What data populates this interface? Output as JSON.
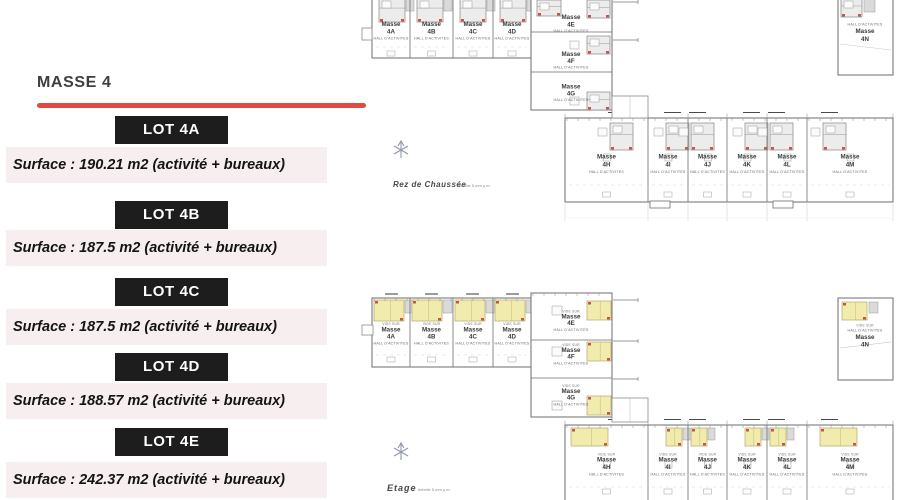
{
  "title": "MASSE 4",
  "lots": [
    {
      "name": "LOT 4A",
      "surface": "Surface : 190.21 m2 (activité + bureaux)"
    },
    {
      "name": "LOT 4B",
      "surface": "Surface : 187.5 m2 (activité + bureaux)"
    },
    {
      "name": "LOT 4C",
      "surface": "Surface : 187.5 m2 (activité + bureaux)"
    },
    {
      "name": "LOT 4D",
      "surface": "Surface : 188.57 m2 (activité + bureaux)"
    },
    {
      "name": "LOT 4E",
      "surface": "Surface : 242.37 m2 (activité + bureaux)"
    }
  ],
  "plans": [
    {
      "id": "rdc",
      "name": "Rez de Chaussée",
      "scale_note": "échelle 5 mm p.m.",
      "unit_word": "Masse",
      "hall_text": "HALL D'ACTIVITES",
      "void_text": "",
      "top_row_units": [
        "4A",
        "4B",
        "4C",
        "4D"
      ],
      "column_units": [
        "4E",
        "4F",
        "4G"
      ],
      "right_unit": "4N",
      "bottom_row_units": [
        "4H",
        "4I",
        "4J",
        "4K",
        "4L",
        "4M"
      ]
    },
    {
      "id": "etage",
      "name": "Etage",
      "scale_note": "échelle 5 mm p.m.",
      "unit_word": "Masse",
      "hall_text": "HALL D'ACTIVITES",
      "void_text": "VIDE SUR",
      "top_row_units": [
        "4A",
        "4B",
        "4C",
        "4D"
      ],
      "column_units": [
        "4E",
        "4F",
        "4G"
      ],
      "right_unit": "4N",
      "bottom_row_units": [
        "4H",
        "4I",
        "4J",
        "4K",
        "4L",
        "4M"
      ]
    }
  ],
  "icons": {
    "compass": "north-compass-icon"
  },
  "colors": {
    "accent_red": "#e14b41",
    "lot_box": "#1d1d1d",
    "band_bg": "#f7eef0",
    "yellow_room": "#f1ebae",
    "plan_line": "#6e6e6e"
  }
}
